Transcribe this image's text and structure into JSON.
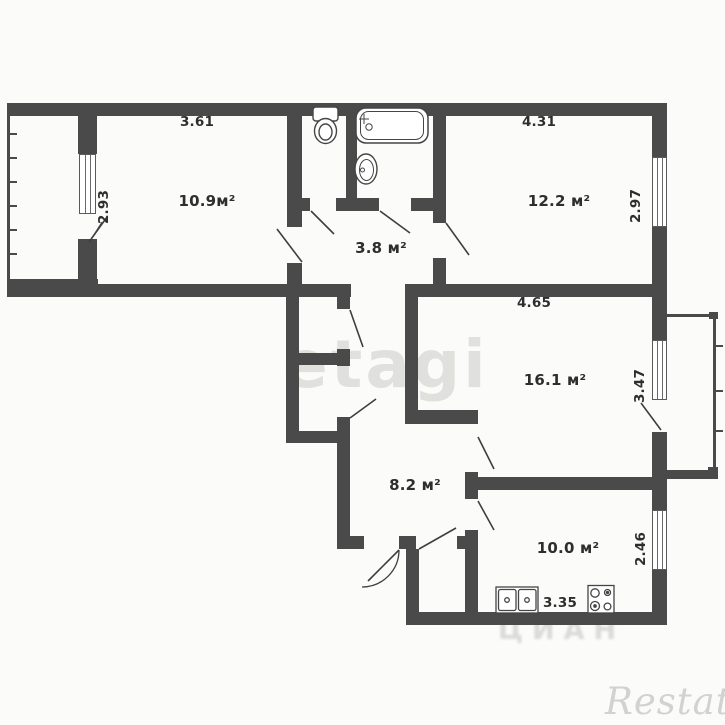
{
  "plan": {
    "rooms": [
      {
        "id": "room-109",
        "area_label": "10.9м²"
      },
      {
        "id": "room-122",
        "area_label": "12.2 м²"
      },
      {
        "id": "hallway-38",
        "area_label": "3.8 м²"
      },
      {
        "id": "room-161",
        "area_label": "16.1 м²"
      },
      {
        "id": "corridor-82",
        "area_label": "8.2 м²"
      },
      {
        "id": "kitchen-100",
        "area_label": "10.0 м²"
      }
    ],
    "dimensions": [
      {
        "id": "dim-361",
        "value": "3.61"
      },
      {
        "id": "dim-293",
        "value": "2.93"
      },
      {
        "id": "dim-431",
        "value": "4.31"
      },
      {
        "id": "dim-297",
        "value": "2.97"
      },
      {
        "id": "dim-465",
        "value": "4.65"
      },
      {
        "id": "dim-347",
        "value": "3.47"
      },
      {
        "id": "dim-246",
        "value": "2.46"
      },
      {
        "id": "dim-335",
        "value": "3.35"
      }
    ],
    "fixtures": [
      "toilet",
      "bathtub",
      "wash-basin",
      "kitchen-sink",
      "stove"
    ],
    "watermarks": {
      "center": "etagi",
      "bottom": "ЦИАН",
      "corner": "Restate"
    },
    "colors": {
      "wall": "#4a4a4a",
      "background": "#fbfbf9",
      "text": "#2e2e2e",
      "watermark": "#cbcbc7"
    }
  }
}
